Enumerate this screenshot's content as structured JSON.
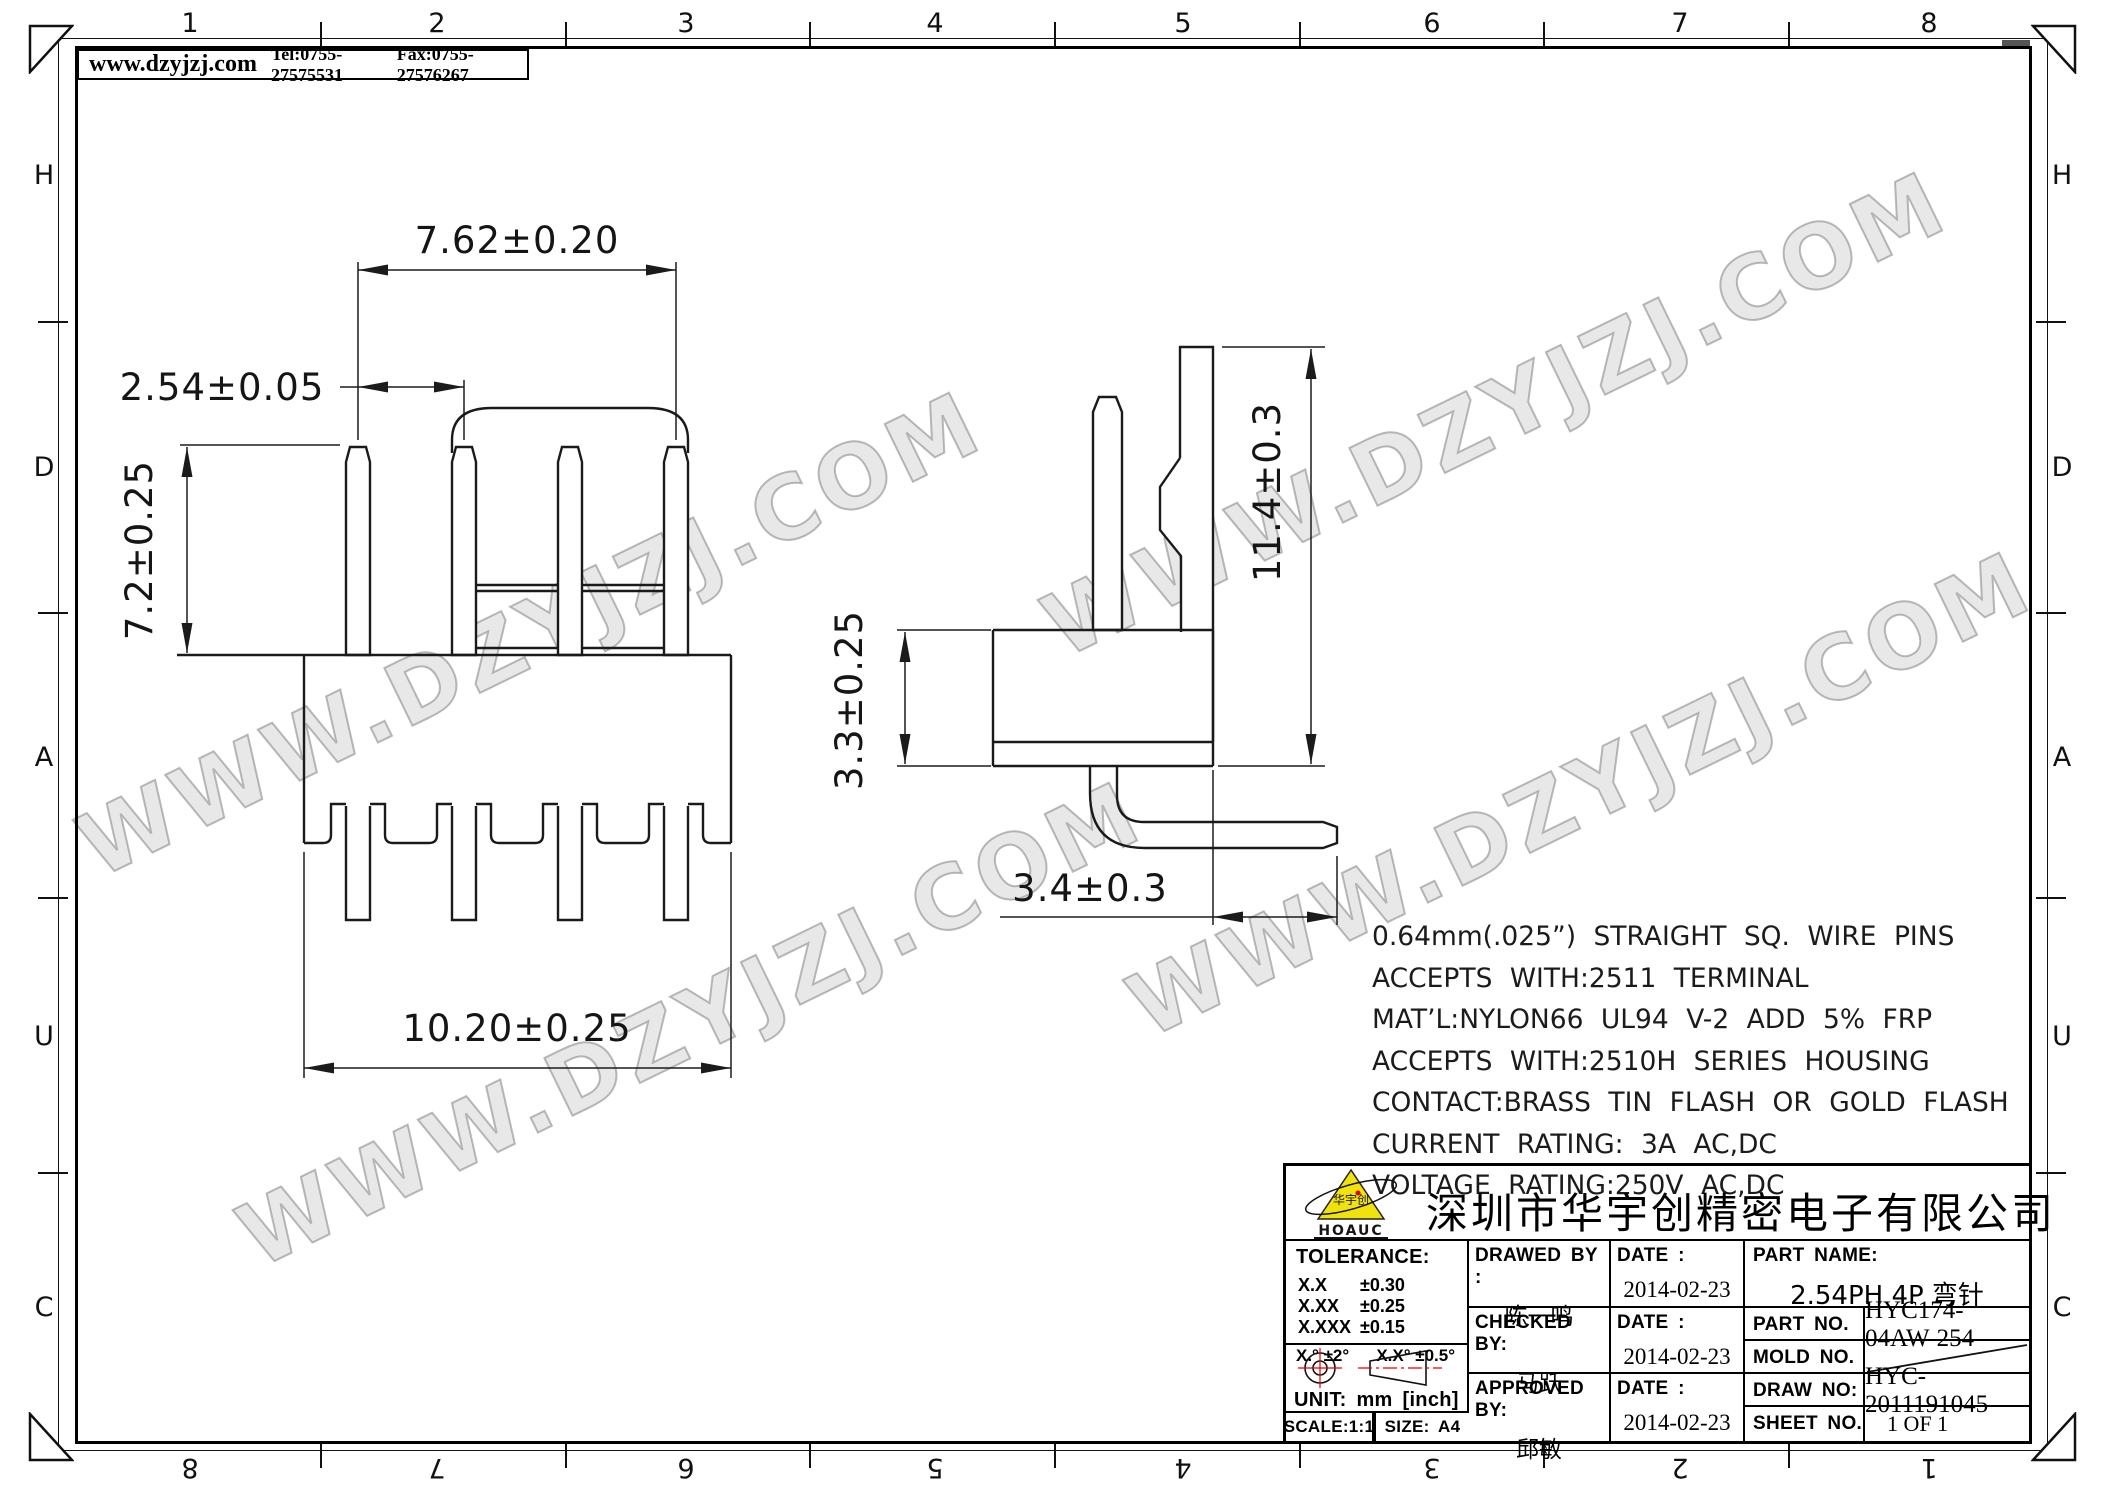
{
  "header": {
    "website": "www.dzyjzj.com",
    "tel": "Tel:0755-27575531",
    "fax": "Fax:0755-27576267"
  },
  "zones": {
    "top": [
      "1",
      "2",
      "3",
      "4",
      "5",
      "6",
      "7",
      "8"
    ],
    "bottom": [
      "8",
      "7",
      "6",
      "5",
      "4",
      "3",
      "2",
      "1"
    ],
    "left": [
      "H",
      "D",
      "A",
      "U",
      "C"
    ],
    "right": [
      "H",
      "D",
      "A",
      "U",
      "C"
    ]
  },
  "watermark": {
    "text": "WWW.DZYJZJ.COM"
  },
  "drawing": {
    "dims": {
      "pitch_total": "7.62±0.20",
      "pitch": "2.54±0.05",
      "pin_length": "7.2±0.25",
      "housing_width": "10.20±0.25",
      "housing_height": "3.3±0.25",
      "overall_height": "11.4±0.3",
      "tail_length": "3.4±0.3"
    }
  },
  "notes": {
    "lines": [
      "0.64mm(.025”) STRAIGHT SQ. WIRE PINS",
      "ACCEPTS WITH:2511 TERMINAL",
      "MAT’L:NYLON66 UL94 V-2 ADD 5% FRP",
      "ACCEPTS WITH:2510H SERIES HOUSING",
      "CONTACT:BRASS TIN FLASH OR GOLD FLASH",
      "CURRENT RATING: 3A AC,DC",
      "VOLTAGE RATING:250V AC,DC"
    ]
  },
  "title_block": {
    "company": "深圳市华宇创精密电子有限公司",
    "logo": {
      "name": "HOAUC",
      "mark": "华宇创"
    },
    "tolerance": {
      "title": "TOLERANCE:",
      "rows": [
        [
          "X.X",
          "±0.30"
        ],
        [
          "X.XX",
          "±0.25"
        ],
        [
          "X.XXX",
          "±0.15"
        ]
      ],
      "angle_left": "X.° ±2°",
      "angle_right": "X.X° ±0.5°"
    },
    "unit": "UNIT: mm [inch]",
    "scale": "SCALE:1:1",
    "size": "SIZE: A4",
    "drawed_label": "DRAWED BY :",
    "drawed_name": "陈一鸣",
    "checked_label": "CHECKED BY:",
    "checked_name": "马跃",
    "approved_label": "APPROVED BY:",
    "approved_name": "邱敏",
    "date_label": "DATE :",
    "date": "2014-02-23",
    "part_name_label": "PART NAME:",
    "part_name": "2.54PH 4P 弯针",
    "part_no_label": "PART NO.",
    "part_no": "HYC174-04AW-254",
    "mold_no_label": "MOLD NO.",
    "draw_no_label": "DRAW NO:",
    "draw_no": "HYC-2011191045",
    "sheet_no_label": "SHEET NO.",
    "sheet_no": "1 OF 1"
  }
}
